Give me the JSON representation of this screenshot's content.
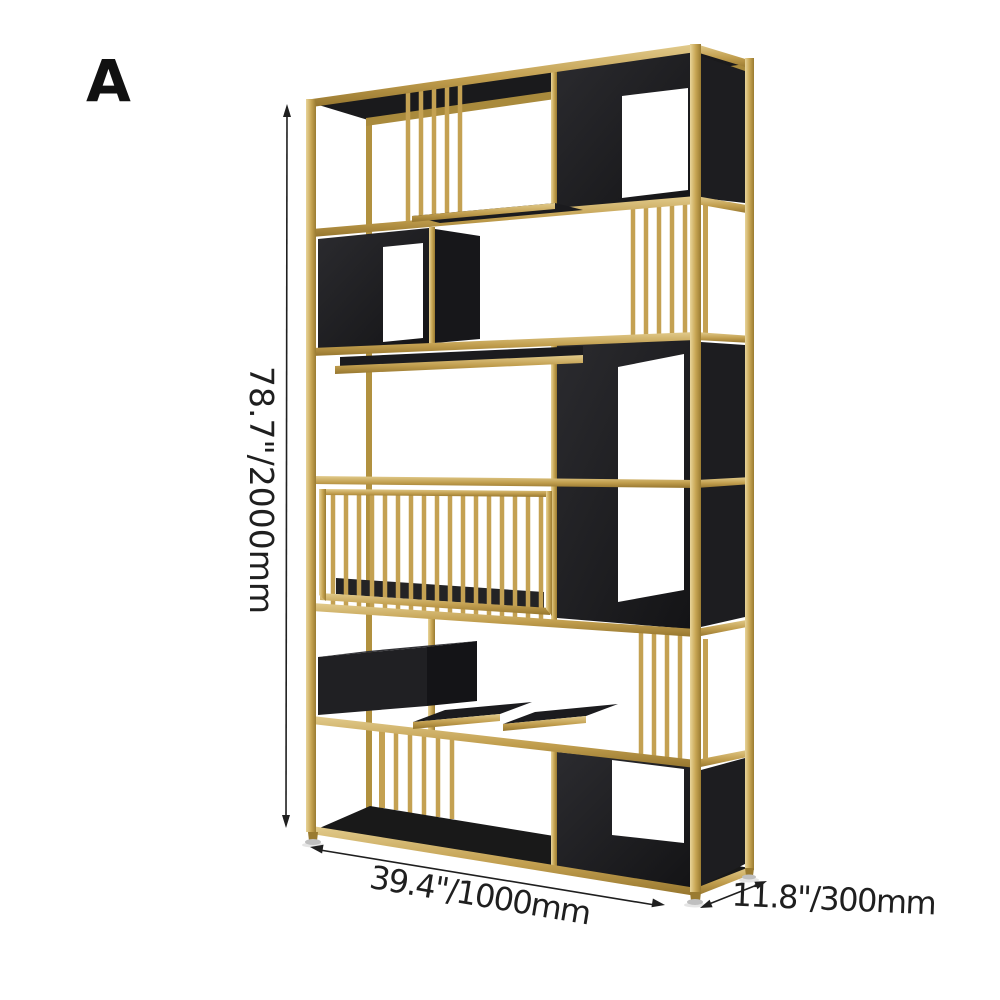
{
  "image": {
    "variant_label": "A"
  },
  "dimensions": {
    "height": "78.7\"/2000mm",
    "width": "39.4\"/1000mm",
    "depth": "11.8\"/300mm"
  },
  "colors": {
    "gold": "#C9A755",
    "gold_light": "#E8D49A",
    "gold_dark": "#9A7B31",
    "panel_black": "#1A1A1C",
    "annotation": "#1F1F1F",
    "background": "#FFFFFF"
  }
}
